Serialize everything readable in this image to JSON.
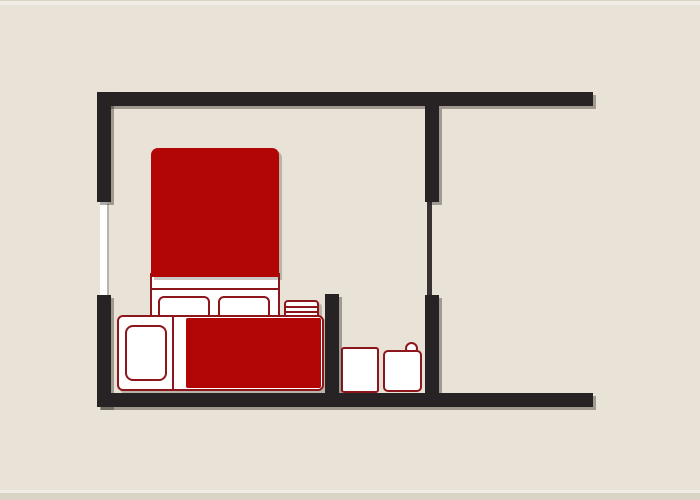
{
  "scene": {
    "description": "Top-down floor plan diagram of a small studio apartment with bedroom furniture in dark red, black walls with drop shadows, and a small bathroom nook, on a beige background. No text labels are rendered in the image.",
    "palette": {
      "background": "#e8e2d7",
      "wall": "#272223",
      "wall_shadow": "rgba(40,34,30,0.38)",
      "soft_shadow": "rgba(70,58,45,0.28)",
      "furniture_red": "#b20505",
      "outline_red": "#8c161b",
      "white": "#ffffff",
      "door_line": "#383233",
      "edge_light": "#f2ede4",
      "edge_dark": "#dad4c7"
    }
  },
  "floorplan": {
    "canvas": {
      "width": 700,
      "height": 500
    },
    "elements": [
      {
        "name": "canvas-top-edge-line",
        "x": 0,
        "y": 0,
        "w": 700,
        "h": 1,
        "fill": "edge_dark"
      },
      {
        "name": "canvas-top-edge-highlight",
        "x": 0,
        "y": 1,
        "w": 700,
        "h": 4,
        "fill": "edge_light"
      },
      {
        "name": "canvas-bottom-edge-highlight",
        "x": 0,
        "y": 490,
        "w": 700,
        "h": 3,
        "fill": "edge_light"
      },
      {
        "name": "canvas-bottom-edge-shade",
        "x": 0,
        "y": 493,
        "w": 700,
        "h": 7,
        "fill": "edge_dark"
      },
      {
        "name": "window-left",
        "x": 100,
        "y": 202,
        "w": 7,
        "h": 93,
        "fill": "white",
        "cls": "window"
      },
      {
        "name": "door-line-right",
        "x": 427,
        "y": 202,
        "w": 5,
        "h": 93,
        "fill": "door_line"
      },
      {
        "name": "bed-base",
        "x": 150,
        "y": 273,
        "w": 130,
        "h": 44,
        "fill": "white",
        "stroke": "outline_red",
        "sw": 2
      },
      {
        "name": "bed-blanket",
        "x": 151,
        "y": 148,
        "w": 128,
        "h": 129,
        "fill": "furniture_red",
        "radius": "7px 7px 0 0",
        "cls": "soft-shadow"
      },
      {
        "name": "bed-sheet-fold-line",
        "x": 150,
        "y": 288,
        "w": 130,
        "h": 2,
        "fill": "outline_red"
      },
      {
        "name": "bed-pillow-left",
        "x": 158,
        "y": 296,
        "w": 52,
        "h": 22,
        "fill": "white",
        "stroke": "outline_red",
        "sw": 2,
        "radius": "6px 6px 3px 3px"
      },
      {
        "name": "bed-pillow-right",
        "x": 218,
        "y": 296,
        "w": 52,
        "h": 22,
        "fill": "white",
        "stroke": "outline_red",
        "sw": 2,
        "radius": "6px 6px 3px 3px"
      },
      {
        "name": "radiator",
        "x": 284,
        "y": 300,
        "w": 35,
        "h": 17,
        "fill": "white",
        "stroke": "outline_red",
        "sw": 2,
        "radius": "4px 4px 0 0",
        "cls": "soft-shadow"
      },
      {
        "name": "radiator-slat-line-1",
        "x": 286,
        "y": 306,
        "w": 31,
        "h": 2,
        "fill": "outline_red"
      },
      {
        "name": "radiator-slat-line-2",
        "x": 286,
        "y": 311,
        "w": 31,
        "h": 2,
        "fill": "outline_red"
      },
      {
        "name": "kitchen-counter-base",
        "x": 117,
        "y": 315,
        "w": 207,
        "h": 76,
        "fill": "white",
        "stroke": "outline_red",
        "sw": 2,
        "radius": "6px",
        "cls": "soft-shadow"
      },
      {
        "name": "kitchen-counter-divider-line",
        "x": 172,
        "y": 315,
        "w": 2,
        "h": 76,
        "fill": "outline_red"
      },
      {
        "name": "kitchen-countertop",
        "x": 186,
        "y": 318,
        "w": 135,
        "h": 70,
        "fill": "furniture_red",
        "radius": "2px"
      },
      {
        "name": "kitchen-sink",
        "x": 125,
        "y": 325,
        "w": 42,
        "h": 56,
        "fill": "white",
        "stroke": "outline_red",
        "sw": 2,
        "radius": "8px"
      },
      {
        "name": "toilet-knob",
        "x": 405,
        "y": 342,
        "w": 13,
        "h": 13,
        "fill": "white",
        "stroke": "outline_red",
        "sw": 2,
        "radius": "50%"
      },
      {
        "name": "washing-machine",
        "x": 341,
        "y": 347,
        "w": 38,
        "h": 46,
        "fill": "white",
        "stroke": "outline_red",
        "sw": 2,
        "radius": "3px"
      },
      {
        "name": "toilet",
        "x": 383,
        "y": 350,
        "w": 39,
        "h": 42,
        "fill": "white",
        "stroke": "outline_red",
        "sw": 2,
        "radius": "5px"
      },
      {
        "name": "wall-top",
        "x": 98,
        "y": 92,
        "w": 495,
        "h": 14,
        "fill": "wall",
        "cls": "wall-shadow"
      },
      {
        "name": "wall-left-upper",
        "x": 97,
        "y": 92,
        "w": 14,
        "h": 110,
        "fill": "wall",
        "cls": "wall-shadow"
      },
      {
        "name": "wall-left-lower",
        "x": 97,
        "y": 295,
        "w": 14,
        "h": 112,
        "fill": "wall",
        "cls": "wall-shadow"
      },
      {
        "name": "wall-right-upper",
        "x": 425,
        "y": 106,
        "w": 14,
        "h": 96,
        "fill": "wall",
        "cls": "wall-shadow"
      },
      {
        "name": "wall-right-lower",
        "x": 425,
        "y": 295,
        "w": 14,
        "h": 98,
        "fill": "wall",
        "cls": "wall-shadow"
      },
      {
        "name": "wall-bathroom-divider",
        "x": 325,
        "y": 294,
        "w": 14,
        "h": 99,
        "fill": "wall",
        "cls": "wall-shadow"
      },
      {
        "name": "wall-bottom",
        "x": 98,
        "y": 393,
        "w": 495,
        "h": 14,
        "fill": "wall",
        "cls": "wall-shadow"
      }
    ]
  }
}
